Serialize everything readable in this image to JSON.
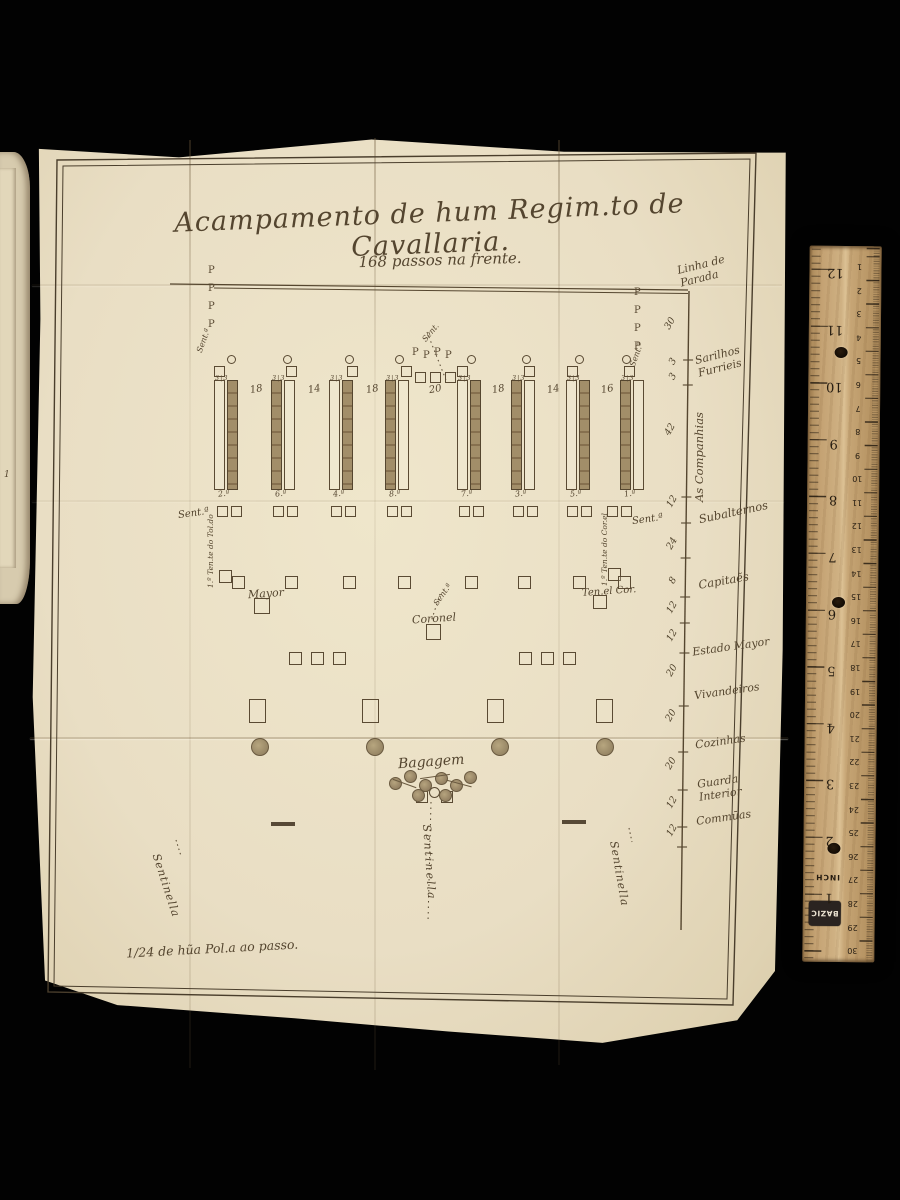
{
  "scene": {
    "background": "#000000",
    "paper_color": "#e9dec4",
    "ink_color": "#54452f"
  },
  "plate": {
    "title": "Acampamento de hum Regim.to de Cavallaria.",
    "subtitle": "168 passos na frente.",
    "scale_note": "1/24 de hũa Pol.a ao passo.",
    "labels": {
      "linha_parada": "Linha de Parada",
      "sent_small": "Sent.ª",
      "sent_short": "Sent.",
      "mayor": "Mayor",
      "coronel": "Coronel",
      "ten_cor": "Ten.el Cor.",
      "left_officer": "1.º Ten.te do Tol.do",
      "right_officer": "1.º Ten.te do Cor.el",
      "bagagem": "Bagagem",
      "sentinella": "Sentinella",
      "page_edge_mark": "1"
    },
    "companies": {
      "count": 8,
      "ids": [
        "2.ª",
        "6.ª",
        "4.ª",
        "8.ª",
        "7.ª",
        "3.ª",
        "5.ª",
        "1.ª"
      ],
      "front_widths": [
        "18",
        "14",
        "18",
        "20",
        "18",
        "14",
        "16"
      ],
      "sarilho_mark": "3|3",
      "flag_mark": "P"
    },
    "scale_rows": [
      {
        "num": "",
        "label": "Linha de Parada"
      },
      {
        "num": "30",
        "label": ""
      },
      {
        "num": "3",
        "label": ""
      },
      {
        "num": "3",
        "label": "Sarilhos Furrieis"
      },
      {
        "num": "42",
        "label": "As Companhias"
      },
      {
        "num": "12",
        "label": "Subalternos"
      },
      {
        "num": "24",
        "label": ""
      },
      {
        "num": "8",
        "label": "Capitaẽs"
      },
      {
        "num": "12",
        "label": ""
      },
      {
        "num": "12",
        "label": "Estado Mayor"
      },
      {
        "num": "20",
        "label": "Vivandeiros"
      },
      {
        "num": "20",
        "label": ""
      },
      {
        "num": "20",
        "label": "Cozinhas"
      },
      {
        "num": "12",
        "label": "Guarda Interior"
      },
      {
        "num": "12",
        "label": "Commūas"
      }
    ]
  },
  "ruler": {
    "brand": "BAZIC",
    "unit_label": "INCH",
    "inch_numbers": [
      "1",
      "2",
      "3",
      "4",
      "5",
      "6",
      "7",
      "8",
      "9",
      "10",
      "11",
      "12"
    ],
    "cm_numbers": [
      "1",
      "2",
      "3",
      "4",
      "5",
      "6",
      "7",
      "8",
      "9",
      "10",
      "11",
      "12",
      "13",
      "14",
      "15",
      "16",
      "17",
      "18",
      "19",
      "20",
      "21",
      "22",
      "23",
      "24",
      "25",
      "26",
      "27",
      "28",
      "29",
      "30"
    ]
  }
}
